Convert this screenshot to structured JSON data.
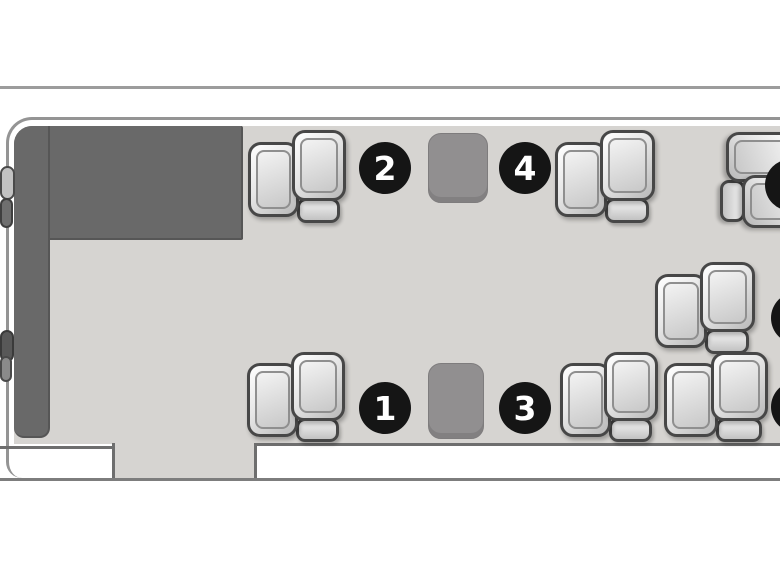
{
  "diagram": {
    "type": "aircraft-cabin-seating-plan",
    "colors": {
      "floor": "#d6d4d1",
      "galley_zone": "#696969",
      "table": "#918f90",
      "badge_background": "#151515",
      "badge_text": "#ffffff",
      "seat_outline": "#474747"
    },
    "seat_badges": [
      {
        "label": "1",
        "cx": 385,
        "cy": 408
      },
      {
        "label": "2",
        "cx": 385,
        "cy": 168
      },
      {
        "label": "3",
        "cx": 525,
        "cy": 408
      },
      {
        "label": "4",
        "cx": 525,
        "cy": 168
      }
    ],
    "partial_badges": [
      {
        "cx": 791,
        "cy": 185
      },
      {
        "cx": 797,
        "cy": 318
      },
      {
        "cx": 797,
        "cy": 407
      }
    ],
    "seats": [
      {
        "id": "seat-top-left",
        "x": 248,
        "y": 130,
        "w": 98,
        "h": 97,
        "rot": 0
      },
      {
        "id": "seat-top-middle",
        "x": 555,
        "y": 130,
        "w": 100,
        "h": 97,
        "rot": 0
      },
      {
        "id": "seat-top-right",
        "x": 716,
        "y": 132,
        "w": 96,
        "h": 96,
        "rot": 90
      },
      {
        "id": "seat-middle-right",
        "x": 655,
        "y": 262,
        "w": 100,
        "h": 96,
        "rot": 0
      },
      {
        "id": "seat-bottom-left",
        "x": 247,
        "y": 352,
        "w": 98,
        "h": 94,
        "rot": 0
      },
      {
        "id": "seat-bottom-middle",
        "x": 560,
        "y": 352,
        "w": 98,
        "h": 94,
        "rot": 0
      },
      {
        "id": "seat-bottom-right",
        "x": 664,
        "y": 352,
        "w": 104,
        "h": 94,
        "rot": 0
      }
    ],
    "tables": [
      {
        "id": "table-top",
        "x": 428,
        "y": 133,
        "w": 60,
        "h": 70
      },
      {
        "id": "table-bottom",
        "x": 428,
        "y": 363,
        "w": 56,
        "h": 76
      }
    ]
  }
}
